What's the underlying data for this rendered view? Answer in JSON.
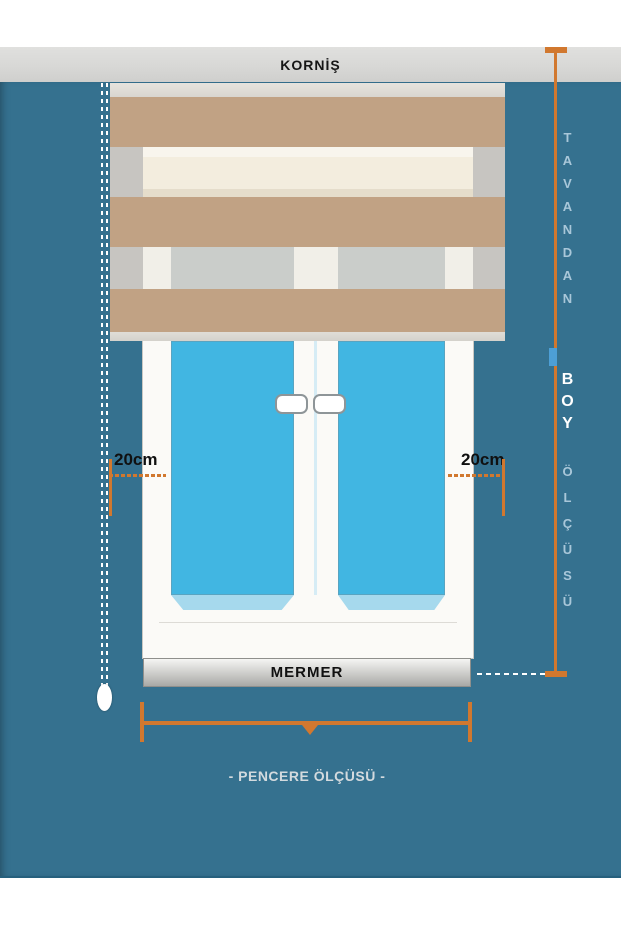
{
  "labels": {
    "cornice": "KORNİŞ",
    "sill": "MERMER",
    "window_width": "- PENCERE ÖLÇÜSÜ -",
    "left_offset": "20cm",
    "right_offset": "20cm"
  },
  "height_measure": {
    "line1": "TAVANDAN",
    "line2": "BOY",
    "line3": "ÖLÇÜSÜ"
  },
  "colors": {
    "wall": "#35718f",
    "band-gray": "#d8d8d6",
    "stripe-tan": "#c1a284",
    "cassette": "#d9d6d0",
    "bottom-bar": "#d4d1cb",
    "sheer-gray": "#c7c5c1",
    "sheer-cream": "#f3edde",
    "sheer-white": "#f1efe8",
    "sheer-glass": "#cacdca",
    "frame-white": "#fbfaf7",
    "glass-blue": "#41b6e2",
    "sill-blue": "#a6d9ed",
    "orange": "#d1782f",
    "text-blue": "#a9c7d9",
    "marker-blue": "#4d9fd6",
    "mermer-light": "#f5f5f3",
    "mermer-dark": "#a9a9a6",
    "pencere-text": "#d3dade"
  }
}
